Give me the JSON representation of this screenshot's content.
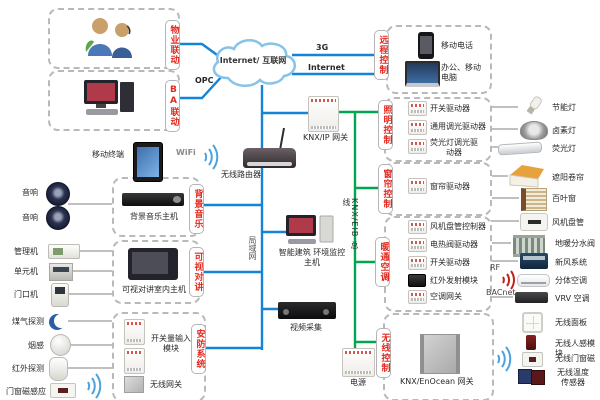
{
  "colors": {
    "wire_blue": "#1583d6",
    "wire_green": "#00a651",
    "tab_red": "#e22a20",
    "wire_gray": "#9a9a9a"
  },
  "cloud": {
    "label": "Internet/ 互联网"
  },
  "wire_labels": {
    "g3": "3G",
    "internet": "Internet",
    "opc": "OPC",
    "wifi": "WiFi",
    "lan": "局域网",
    "knx_bus": "KNX/EIB 总线",
    "rf": "RF",
    "bacnet": "BACnet"
  },
  "left": {
    "property": {
      "tab": "物业联动"
    },
    "ba": {
      "tab": "BA联动"
    },
    "mobile_terminal": {
      "label": "移动终端"
    },
    "speakers": {
      "label1": "音响",
      "label2": "音响"
    },
    "music": {
      "tab": "背景音乐",
      "host": "背景音乐主机"
    },
    "intercom": {
      "tab": "可视对讲",
      "host": "可视对讲室内主机",
      "mgmt": "管理机",
      "unit": "单元机",
      "door": "门口机"
    },
    "security": {
      "tab": "安防系统",
      "input_module": "开关量输入模块",
      "wireless_gw": "无线网关",
      "gas": "煤气探测",
      "smoke": "烟感",
      "ir": "红外探测",
      "magnet": "门窗磁感应"
    }
  },
  "middle": {
    "router": "无线路由器",
    "knx_ip_gw": "KNX/IP 网关",
    "building_host": "智能建筑 环境监控主机",
    "video": "视频采集",
    "power": "电源"
  },
  "right": {
    "remote": {
      "tab": "远程控制",
      "phone": "移动电话",
      "computer": "办公、移动电脑"
    },
    "lighting": {
      "tab": "照明控制",
      "items": [
        "开关驱动器",
        "通用调光驱动器",
        "荧光灯调光驱动器"
      ],
      "targets": [
        "节能灯",
        "卤素灯",
        "荧光灯"
      ]
    },
    "curtain": {
      "tab": "窗帘控制",
      "driver": "窗帘驱动器",
      "targets": [
        "遮阳卷帘",
        "百叶窗"
      ]
    },
    "hvac": {
      "tab": "暖通空调",
      "items": [
        "风机盘管控制器",
        "电热阀驱动器",
        "开关驱动器",
        "红外发射模块",
        "空调网关"
      ],
      "targets": [
        "风机盘管",
        "地暖分水阀",
        "新风系统",
        "分体空调",
        "VRV 空调"
      ]
    },
    "wireless": {
      "tab": "无线控制",
      "gateway": "KNX/EnOcean 网关",
      "targets": [
        "无线面板",
        "无线人感模块",
        "无线门窗磁",
        "无线温度传感器"
      ]
    }
  }
}
